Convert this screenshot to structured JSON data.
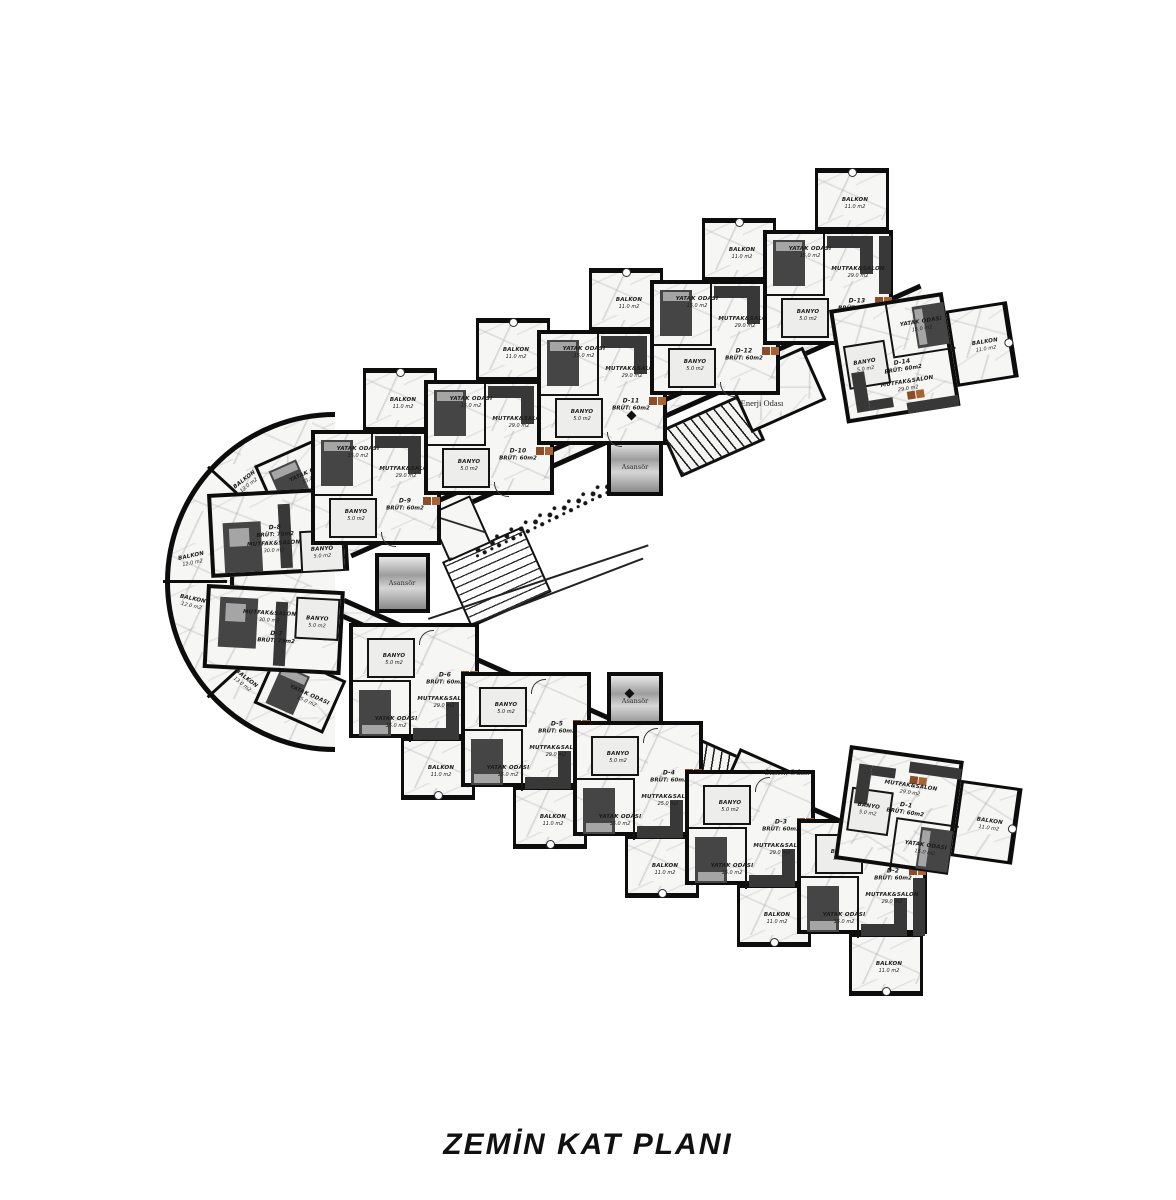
{
  "title": "ZEMİN KAT PLANI",
  "labels": {
    "balkon": "BALKON",
    "mutfak": "MUTFAK&SALON",
    "yatak": "YATAK ODASI",
    "banyo": "BANYO",
    "elevator": "Asansör",
    "energy_room": "Enerji Odası",
    "system_room": "Sistem Odası"
  },
  "units": [
    {
      "id": "D-1",
      "brut": "BRÜT: 60m2",
      "mutfak": "29.0 m2",
      "yatak": "15.0 m2",
      "banyo": "5.0 m2",
      "balkon": "11.0 m2"
    },
    {
      "id": "D-2",
      "brut": "BRÜT: 60m2",
      "mutfak": "29.0 m2",
      "yatak": "15.0 m2",
      "banyo": "5.0 m2",
      "balkon": "11.0 m2"
    },
    {
      "id": "D-3",
      "brut": "BRÜT: 60m2",
      "mutfak": "29.0 m2",
      "yatak": "15.0 m2",
      "banyo": "5.0 m2",
      "balkon": "11.0 m2"
    },
    {
      "id": "D-4",
      "brut": "BRÜT: 60m2",
      "mutfak": "25.0 m2",
      "yatak": "15.0 m2",
      "banyo": "5.0 m2",
      "balkon": "11.0 m2"
    },
    {
      "id": "D-5",
      "brut": "BRÜT: 60m2",
      "mutfak": "29.0 m2",
      "yatak": "15.0 m2",
      "banyo": "5.0 m2",
      "balkon": "11.0 m2"
    },
    {
      "id": "D-6",
      "brut": "BRÜT: 60m2",
      "mutfak": "29.0 m2",
      "yatak": "15.0 m2",
      "banyo": "5.0 m2",
      "balkon": "11.0 m2"
    },
    {
      "id": "D-7",
      "brut": "BRÜT: 75m2",
      "mutfak": "30.0 m2",
      "yatak": "15.0 m2",
      "banyo": "5.0 m2",
      "balkon": "12.0 m2"
    },
    {
      "id": "D-8",
      "brut": "BRÜT: 75m2",
      "mutfak": "30.0 m2",
      "yatak": "15.0 m2",
      "banyo": "5.0 m2",
      "balkon": "12.0 m2"
    },
    {
      "id": "D-9",
      "brut": "BRÜT: 60m2",
      "mutfak": "29.0 m2",
      "yatak": "15.0 m2",
      "banyo": "5.0 m2",
      "balkon": "11.0 m2"
    },
    {
      "id": "D-10",
      "brut": "BRÜT: 60m2",
      "mutfak": "29.0 m2",
      "yatak": "15.0 m2",
      "banyo": "5.0 m2",
      "balkon": "11.0 m2"
    },
    {
      "id": "D-11",
      "brut": "BRÜT: 60m2",
      "mutfak": "29.0 m2",
      "yatak": "15.0 m2",
      "banyo": "5.0 m2",
      "balkon": "11.0 m2"
    },
    {
      "id": "D-12",
      "brut": "BRÜT: 60m2",
      "mutfak": "29.0 m2",
      "yatak": "15.0 m2",
      "banyo": "5.0 m2",
      "balkon": "11.0 m2"
    },
    {
      "id": "D-13",
      "brut": "BRÜT: 60m2",
      "mutfak": "29.0 m2",
      "yatak": "15.0 m2",
      "banyo": "5.0 m2",
      "balkon": "11.0 m2"
    },
    {
      "id": "D-14",
      "brut": "BRÜT: 60m2",
      "mutfak": "29.0 m2",
      "yatak": "15.0 m2",
      "banyo": "5.0 m2",
      "balkon": "11.0 m2"
    }
  ],
  "vertex_balkon_areas": [
    "13.0 m2",
    "12.0 m2",
    "12.0 m2",
    "13.0 m2"
  ]
}
